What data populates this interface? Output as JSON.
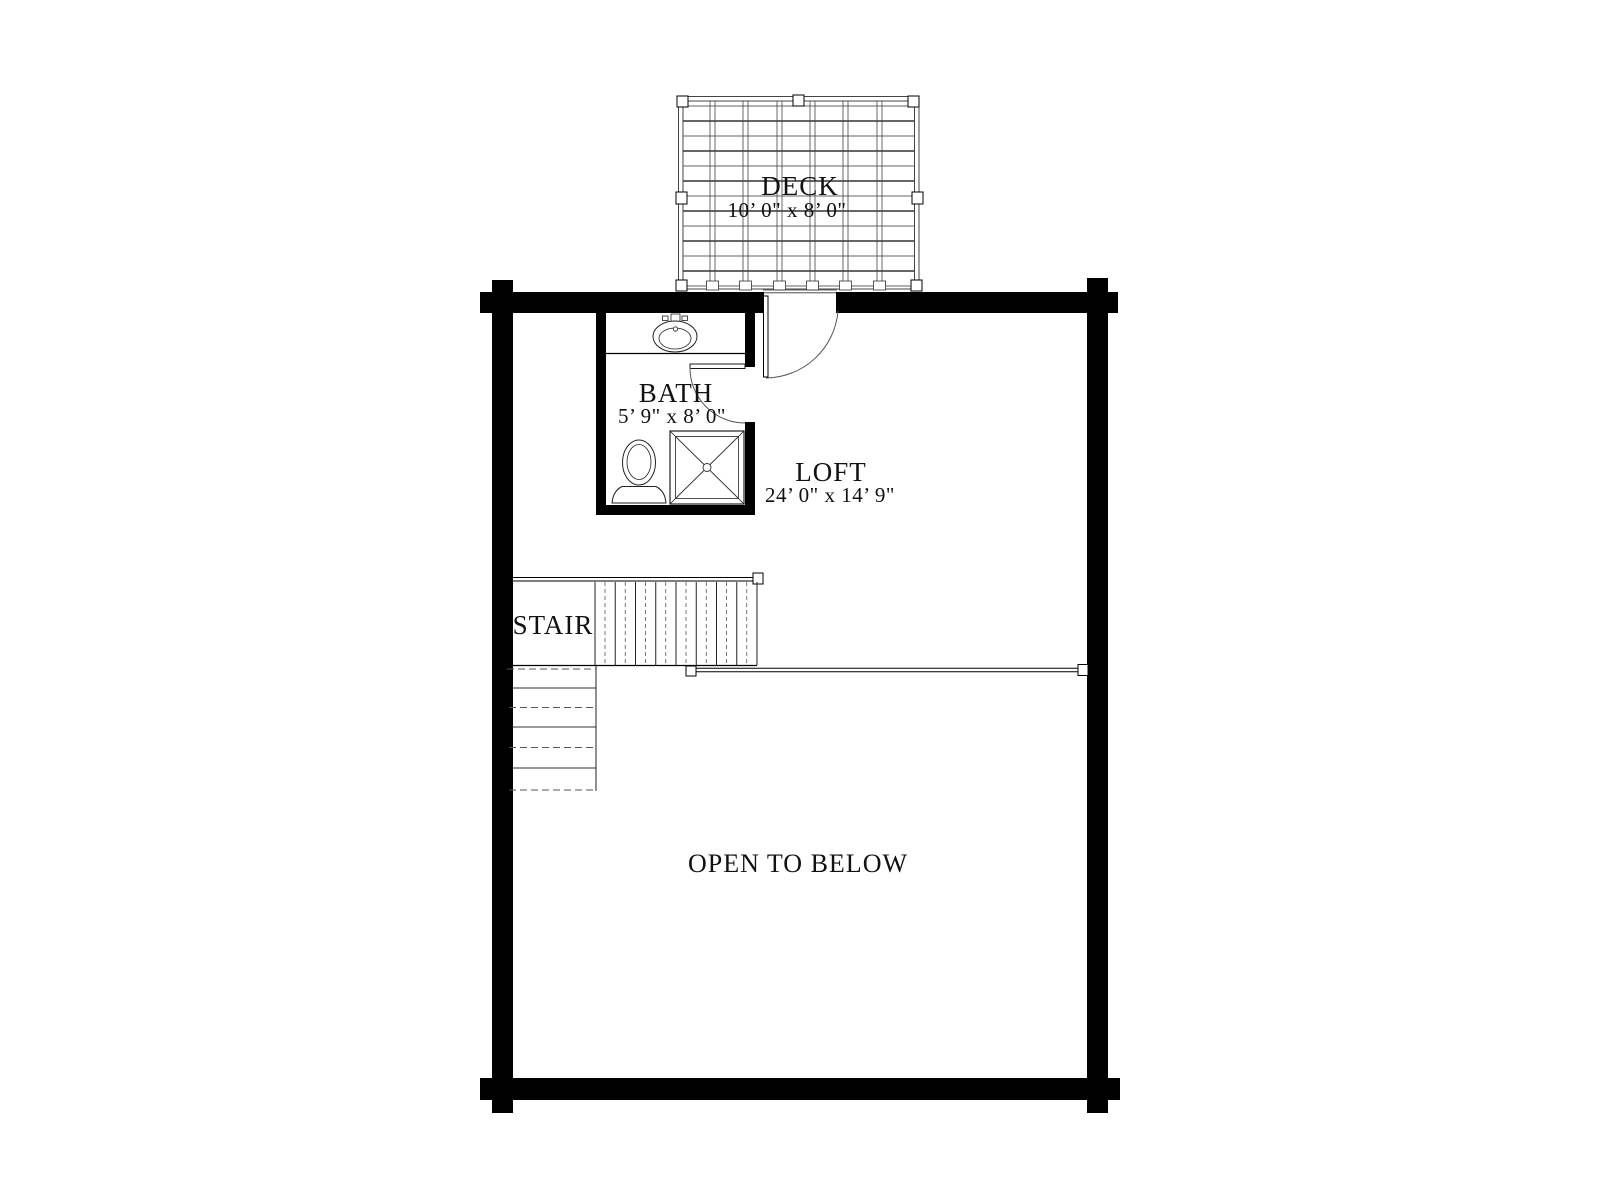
{
  "plan": {
    "type": "second-floor-plan",
    "rooms": {
      "deck": {
        "label": "DECK",
        "dimensions": "10’ 0\" x 8’ 0\""
      },
      "bath": {
        "label": "BATH",
        "dimensions": "5’ 9\" x 8’ 0\""
      },
      "loft": {
        "label": "LOFT",
        "dimensions": "24’ 0\" x 14’ 9\""
      },
      "stair": {
        "label": "STAIR"
      },
      "open_to_below": {
        "label": "OPEN TO BELOW"
      }
    },
    "colors": {
      "wall": "#000000",
      "thin_line": "#444444",
      "background": "#ffffff"
    }
  }
}
